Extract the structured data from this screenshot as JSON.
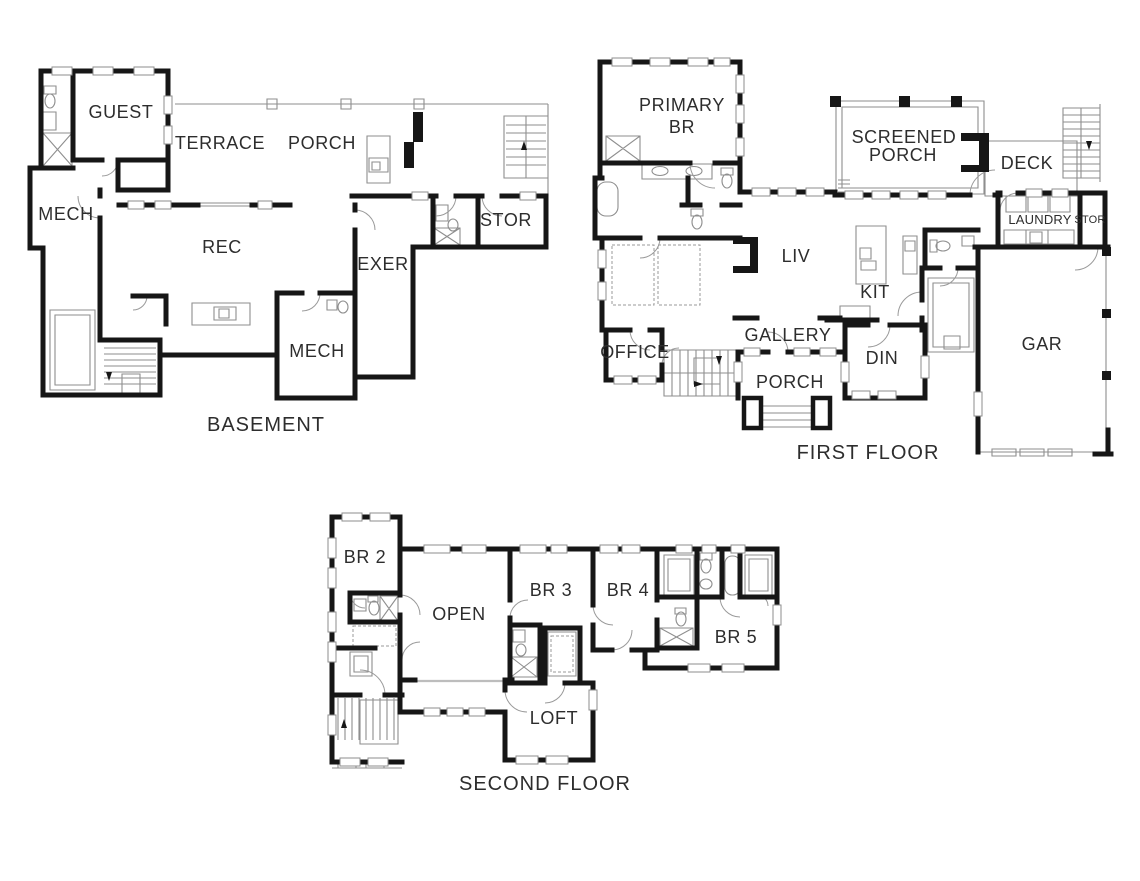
{
  "page": {
    "background": "#ffffff"
  },
  "colors": {
    "wall": "#161616",
    "thin_line": "#8e8e8e",
    "text": "#2d2d2d"
  },
  "plans": {
    "basement": {
      "title": "BASEMENT",
      "rooms": {
        "guest": "GUEST",
        "terrace": "TERRACE",
        "porch": "PORCH",
        "mech": "MECH",
        "rec": "REC",
        "exer": "EXER",
        "stor": "STOR",
        "mech2": "MECH"
      }
    },
    "first_floor": {
      "title": "FIRST FLOOR",
      "rooms": {
        "primary_line1": "PRIMARY",
        "primary_line2": "BR",
        "screened_line1": "SCREENED",
        "screened_line2": "PORCH",
        "deck": "DECK",
        "laundry": "LAUNDRY",
        "stor": "STOR",
        "liv": "LIV",
        "kit": "KIT",
        "gallery": "GALLERY",
        "office": "OFFICE",
        "din": "DIN",
        "porch": "PORCH",
        "gar": "GAR"
      }
    },
    "second_floor": {
      "title": "SECOND FLOOR",
      "rooms": {
        "br2": "BR 2",
        "open": "OPEN",
        "br3": "BR 3",
        "br4": "BR 4",
        "br5": "BR 5",
        "loft": "LOFT"
      }
    }
  }
}
